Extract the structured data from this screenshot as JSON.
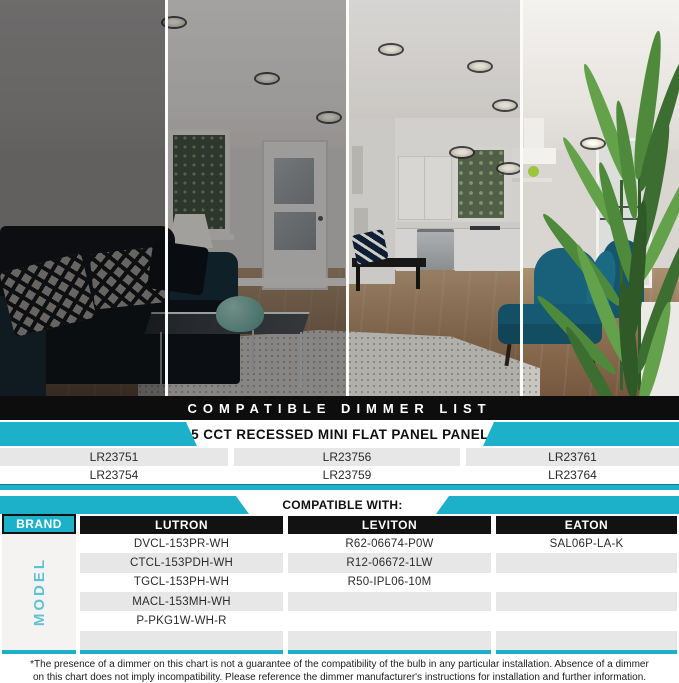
{
  "colors": {
    "accent_teal": "#1db0c9",
    "banner_bg": "#0d0d0d",
    "row_gray": "#e7e7e7",
    "model_label_teal": "#5fc2d3"
  },
  "photo": {
    "description": "living room shown in four vertical strips from dark to bright to demonstrate dimming levels"
  },
  "banner": {
    "title": "COMPATIBLE DIMMER LIST"
  },
  "product_table": {
    "header": "5 CCT RECESSED MINI FLAT PANEL PANEL",
    "rows": [
      [
        "LR23751",
        "LR23756",
        "LR23761"
      ],
      [
        "LR23754",
        "LR23759",
        "LR23764"
      ]
    ]
  },
  "compat_table": {
    "header": "COMPATIBLE WITH:",
    "brand_label": "BRAND",
    "model_label": "MODEL",
    "brands": [
      "LUTRON",
      "LEVITON",
      "EATON"
    ],
    "models": {
      "lutron": [
        "DVCL-153PR-WH",
        "CTCL-153PDH-WH",
        "TGCL-153PH-WH",
        "MACL-153MH-WH",
        "P-PKG1W-WH-R",
        ""
      ],
      "leviton": [
        "R62-06674-P0W",
        "R12-06672-1LW",
        "R50-IPL06-10M",
        "",
        "",
        ""
      ],
      "eaton": [
        "SAL06P-LA-K",
        "",
        "",
        "",
        "",
        ""
      ]
    }
  },
  "footnote": "*The presence of a dimmer on this chart is not a guarantee of the compatibility of the bulb in any particular installation. Absence of a dimmer on this chart does not imply incompatibility. Please reference the dimmer manufacturer's instructions for installation and further information."
}
